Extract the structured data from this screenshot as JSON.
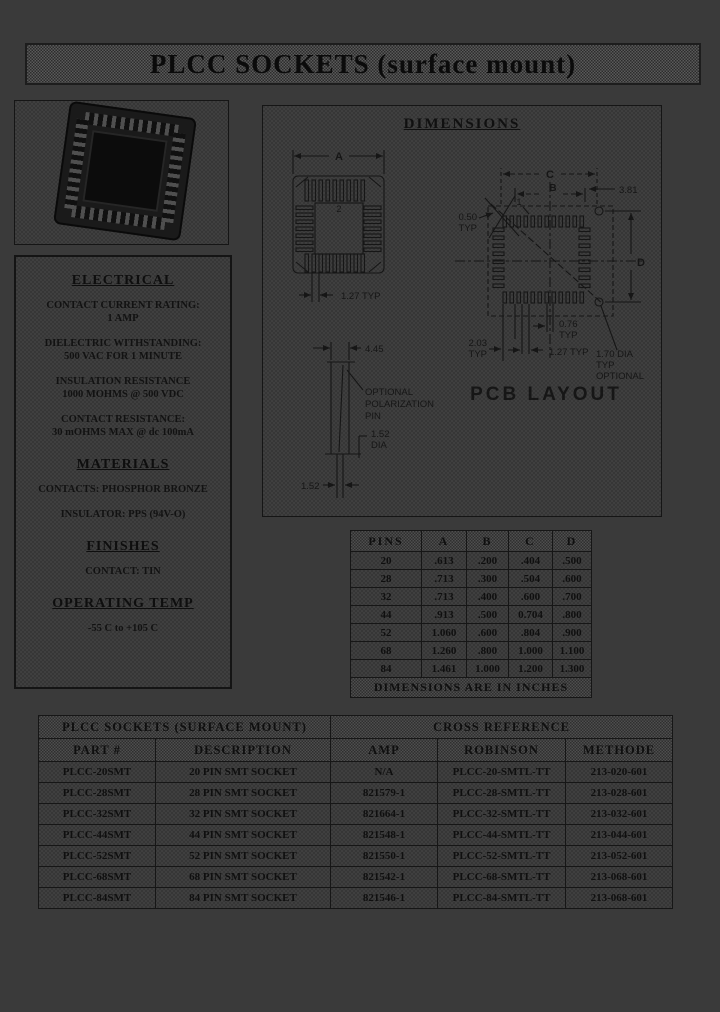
{
  "page": {
    "title": "PLCC SOCKETS (surface mount)"
  },
  "specs": {
    "electrical": {
      "heading": "ELECTRICAL",
      "lines": [
        "CONTACT CURRENT RATING:",
        "1 AMP",
        "DIELECTRIC WITHSTANDING:",
        "500 VAC FOR 1 MINUTE",
        "INSULATION RESISTANCE",
        "1000 MOHMS @ 500 VDC",
        "CONTACT RESISTANCE:",
        "30 mOHMS MAX @ dc 100mA"
      ]
    },
    "materials": {
      "heading": "MATERIALS",
      "lines": [
        "CONTACTS: PHOSPHOR BRONZE",
        "INSULATOR: PPS (94V-O)"
      ]
    },
    "finishes": {
      "heading": "FINISHES",
      "lines": [
        "CONTACT: TIN"
      ]
    },
    "operating": {
      "heading": "OPERATING TEMP",
      "lines": [
        "-55 C to +105 C"
      ]
    }
  },
  "diagram": {
    "heading": "DIMENSIONS",
    "top_view": {
      "a": "A",
      "pin2": "2",
      "pitch": "1.27 TYP"
    },
    "side_view": {
      "height": "4.45",
      "note1": "OPTIONAL",
      "note2": "POLARIZATION",
      "note3": "PIN",
      "dia1": "1.52",
      "dia2": "DIA",
      "width": "1.52"
    },
    "pcb": {
      "c": "C",
      "b": "B",
      "pin1": "1",
      "offset": "3.81",
      "pad_w1": "0.50",
      "pad_w2": "TYP",
      "d": "D",
      "row1": "2.03",
      "row2": "TYP",
      "padh1": "0.76",
      "padh2": "TYP",
      "pitch": "1.27 TYP",
      "hole1": "1.70 DIA",
      "hole2": "TYP",
      "hole3": "OPTIONAL",
      "caption": "PCB LAYOUT"
    }
  },
  "dims_table": {
    "headers": [
      "PINS",
      "A",
      "B",
      "C",
      "D"
    ],
    "rows": [
      [
        "20",
        ".613",
        ".200",
        ".404",
        ".500"
      ],
      [
        "28",
        ".713",
        ".300",
        ".504",
        ".600"
      ],
      [
        "32",
        ".713",
        ".400",
        ".600",
        ".700"
      ],
      [
        "44",
        ".913",
        ".500",
        "0.704",
        ".800"
      ],
      [
        "52",
        "1.060",
        ".600",
        ".804",
        ".900"
      ],
      [
        "68",
        "1.260",
        ".800",
        "1.000",
        "1.100"
      ],
      [
        "84",
        "1.461",
        "1.000",
        "1.200",
        "1.300"
      ]
    ],
    "footer": "DIMENSIONS ARE IN INCHES"
  },
  "parts_table": {
    "group_headers": [
      "PLCC SOCKETS (SURFACE MOUNT)",
      "CROSS REFERENCE"
    ],
    "headers": [
      "PART #",
      "DESCRIPTION",
      "AMP",
      "ROBINSON",
      "METHODE"
    ],
    "rows": [
      [
        "PLCC-20SMT",
        "20 PIN SMT SOCKET",
        "N/A",
        "PLCC-20-SMTL-TT",
        "213-020-601"
      ],
      [
        "PLCC-28SMT",
        "28 PIN SMT SOCKET",
        "821579-1",
        "PLCC-28-SMTL-TT",
        "213-028-601"
      ],
      [
        "PLCC-32SMT",
        "32 PIN SMT SOCKET",
        "821664-1",
        "PLCC-32-SMTL-TT",
        "213-032-601"
      ],
      [
        "PLCC-44SMT",
        "44 PIN SMT SOCKET",
        "821548-1",
        "PLCC-44-SMTL-TT",
        "213-044-601"
      ],
      [
        "PLCC-52SMT",
        "52 PIN SMT SOCKET",
        "821550-1",
        "PLCC-52-SMTL-TT",
        "213-052-601"
      ],
      [
        "PLCC-68SMT",
        "68 PIN SMT SOCKET",
        "821542-1",
        "PLCC-68-SMTL-TT",
        "213-068-601"
      ],
      [
        "PLCC-84SMT",
        "84 PIN SMT SOCKET",
        "821546-1",
        "PLCC-84-SMTL-TT",
        "213-068-601"
      ]
    ]
  }
}
